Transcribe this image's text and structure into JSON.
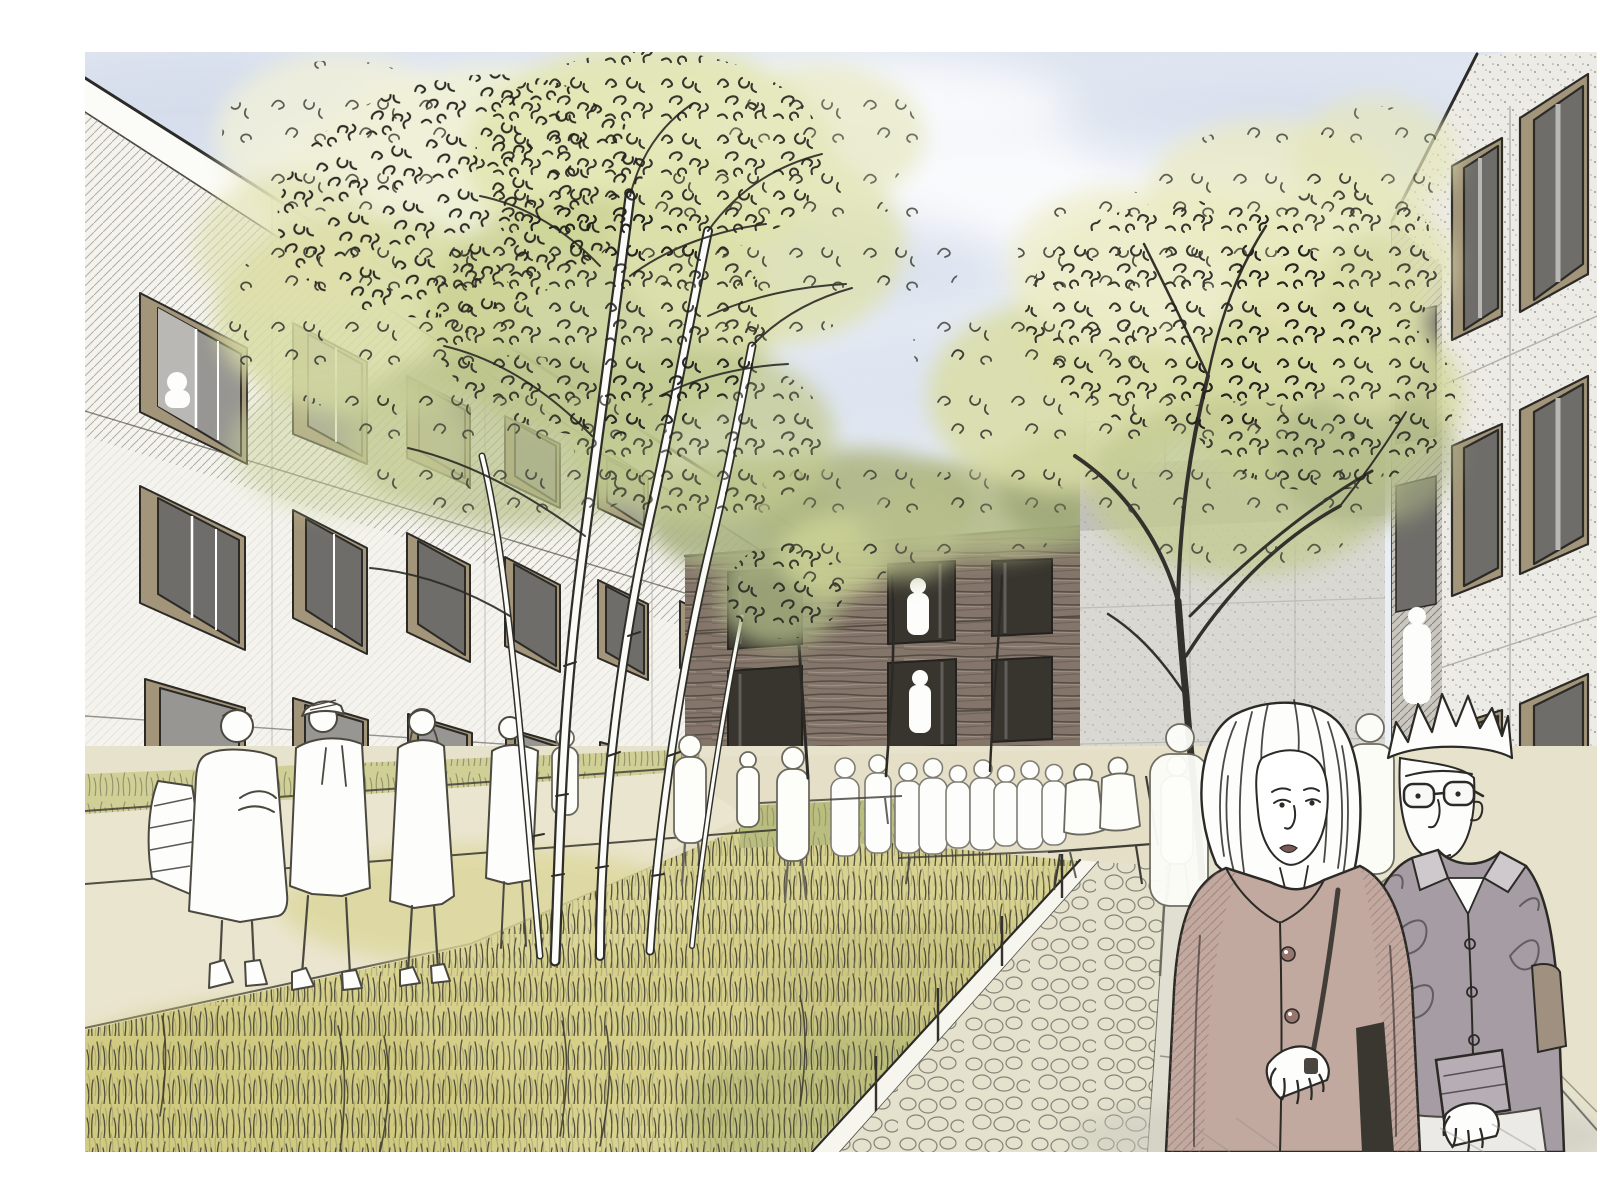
{
  "artwork": {
    "kind": "architectural-concept-sketch",
    "medium": "ink line work with watercolor wash",
    "scene": "pedestrian courtyard between new residential buildings with wild-grass meadow, birch trees and people strolling",
    "elements": {
      "sky": "pale blue-grey watercolor sky with soft clouds",
      "left_building": "white 3-storey facade in perspective, grid of windows with tan reveals and grey glazing, diagonal pencil hatching",
      "timber_building": "background 3-storey building clad in horizontal timber boards with dark window openings and ground-floor passage",
      "gable_wall": "light grey speckled concrete end wall",
      "pencil_building": "faint uncolored sketched block behind the large tree",
      "right_building": "speckled light facade at right with tall tan-framed windows, receding left",
      "birch_trees": "cluster of white-stemmed birches with yellow-green scribbled foliage",
      "large_tree": "dark-stemmed tree in front of the gable wall, broad yellow-green canopy",
      "meadow": "tall wild grass in yellow and olive washes with vertical ink strokes",
      "left_footpath": "beige path along the left building with sketched pedestrians",
      "cobble_path": "irregular stone-paved strip with white edging and thin posts",
      "paved_walkway": "smooth light slab pavement in front of the right building",
      "crowd": "white silhouette figures gathered at the timber building",
      "seated_figures": "two silhouettes on a bench by the grey wall",
      "foreground_woman": "blonde woman in a dusty-rose button coat holding a bag strap",
      "foreground_man": "man with spiky hair and round glasses in a grey-mauve shirt with rolled cuff"
    },
    "palette": {
      "sky": "#e7ebf3",
      "skyDeep": "#ccd6e8",
      "cloud": "#ffffff",
      "paper": "#ffffff",
      "facadeLeft": "#f4f3ed",
      "parapet": "#fbfbf8",
      "facadeRight": "#edebe6",
      "frameTan": "#a3957a",
      "frameTanDark": "#8c7f66",
      "glassDark": "#6e6d69",
      "glassDeep": "#38352f",
      "glassMid": "#979692",
      "glassLight": "#b9b8b4",
      "woodMid": "#84756a",
      "woodDark": "#50473d",
      "woodLight": "#a2948a",
      "wallGrey": "#d9d8d3",
      "wallShade": "#b8b7b1",
      "pencil": "#8f8d86",
      "ink": "#2b2a26",
      "sketch": "#4a483f",
      "foliagePale": "#eef0d4",
      "foliageYellow": "#e0e3ac",
      "foliageGreen": "#cbd295",
      "foliageSage": "#aab383",
      "foliageDark": "#8e9770",
      "grassBase": "#d8d290",
      "grassYellow": "#e3da96",
      "grassGreen": "#b8bd7c",
      "grassOlive": "#9fa477",
      "grassInk": "#4b4936",
      "pathBeige": "#eae5cf",
      "pathBand": "#e4dfc6",
      "cobble": "#e4e1cd",
      "slab": "#e0dfd1",
      "coatRose": "#c2a9a0",
      "coatRoseDeep": "#99766d",
      "lipRose": "#7a5a55",
      "shirtMauve": "#a69ca4",
      "shirtMauveDeep": "#70676f",
      "bagTan": "#a09080",
      "white": "#fdfdfb"
    }
  }
}
